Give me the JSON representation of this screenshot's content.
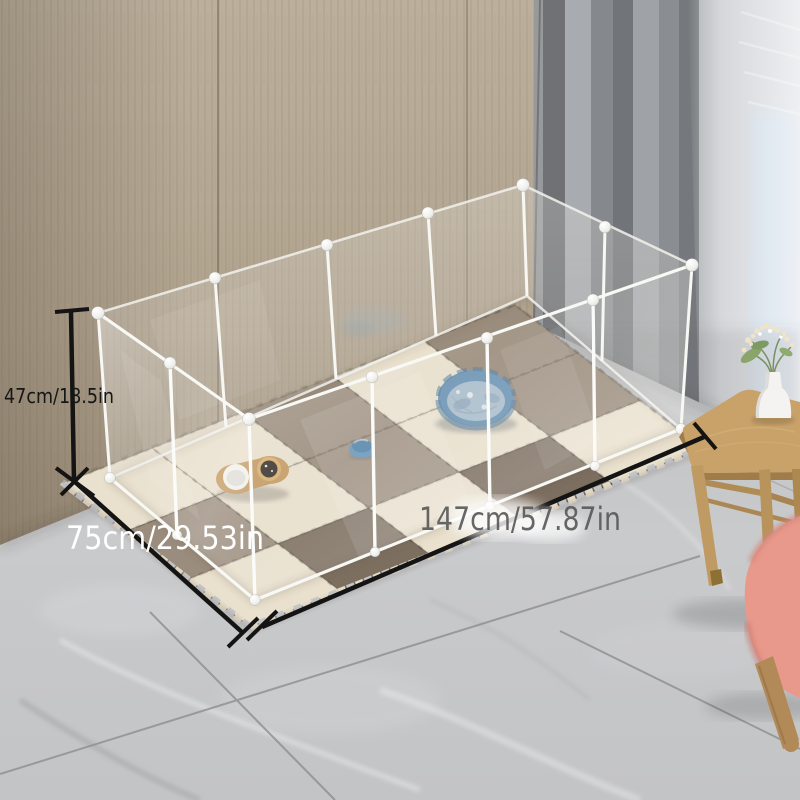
{
  "annotations": {
    "height_label": "47cm/18.5in",
    "width_label": "75cm/29.53in",
    "length_label": "147cm/57.87in"
  },
  "label_styles": {
    "height_color": "#161616",
    "width_color": "#ffffff",
    "length_color": "#575757"
  },
  "colors": {
    "wall_wood": "#b2a490",
    "curtain_gray": "#8d9093",
    "sheer_white": "#e8e9eb",
    "window_blue": "#9fc0de",
    "floor_marble": "#c6c7c9",
    "grout": "#8e8e8c",
    "mat_cream": "#e9e0cd",
    "mat_taupe": "#9b8d7d",
    "mat_dark_brown": "#7d6f60",
    "pen_frame_white": "#f7f7f4",
    "bed_blue": "#6d95b5",
    "bed_cushion": "#abbecd",
    "toy_blue": "#5d90b8",
    "bowl_wood": "#c49a62",
    "stool_wood": "#c8a269",
    "chair_pink": "#e8998b",
    "dimension_line": "#141414"
  },
  "mats": {
    "cols": 5,
    "rows": 3,
    "origin": [
      250,
      627
    ],
    "u": [
      90.6,
      -35.8
    ],
    "v": [
      -62.7,
      -47.7
    ],
    "palette": [
      "#e9e0cd",
      "#9b8d7d",
      "#7d6f60"
    ],
    "pattern": [
      [
        0,
        2,
        0,
        2,
        0
      ],
      [
        1,
        0,
        1,
        0,
        1
      ],
      [
        0,
        0,
        1,
        0,
        1
      ]
    ]
  }
}
